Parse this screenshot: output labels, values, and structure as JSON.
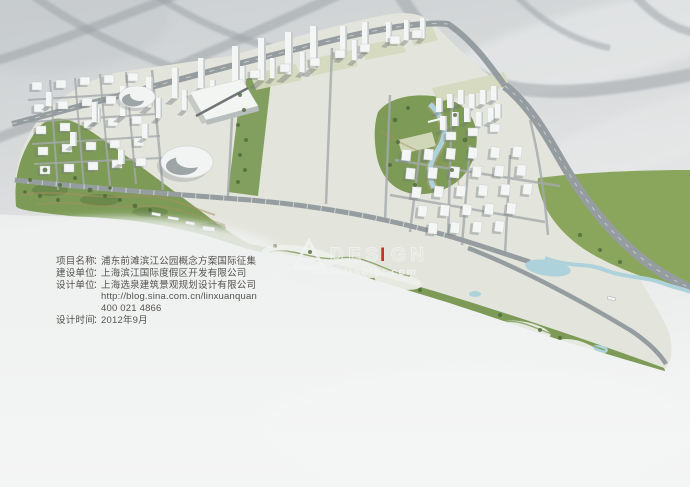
{
  "info_panel": {
    "rows": [
      {
        "label": "项目名称",
        "sep": "：",
        "value": "浦东前滩滨江公园概念方案国际征集"
      },
      {
        "label": "建设单位",
        "sep": "：",
        "value": "上海滨江国际度假区开发有限公司"
      },
      {
        "label": "设计单位",
        "sep": "：",
        "value": "上海选泉建筑景观规划设计有限公司"
      },
      {
        "label": "",
        "sep": "",
        "value": "http://blog.sina.com.cn/linxuanquan"
      },
      {
        "label": "",
        "sep": "",
        "value": "400 021 4866"
      },
      {
        "label": "设计时间",
        "sep": "：",
        "value": "2012年9月"
      }
    ]
  },
  "watermark": {
    "logo": "triangle-A",
    "brand_pre": "DES",
    "brand_i": "I",
    "brand_post": "GN",
    "url": "www.linoliu.com"
  },
  "colors": {
    "park_green": "#7d9b57",
    "field_green": "#8aa65c",
    "water_blue": "#aed2db",
    "road_gray": "#9aa0a4",
    "building_white": "#f4f6f5",
    "khaki": "#d5d9be",
    "watermark_white": "#f2f3f2",
    "watermark_red": "#c6291d",
    "info_text": "#55544f",
    "background_gray": "#d6d8d9"
  }
}
